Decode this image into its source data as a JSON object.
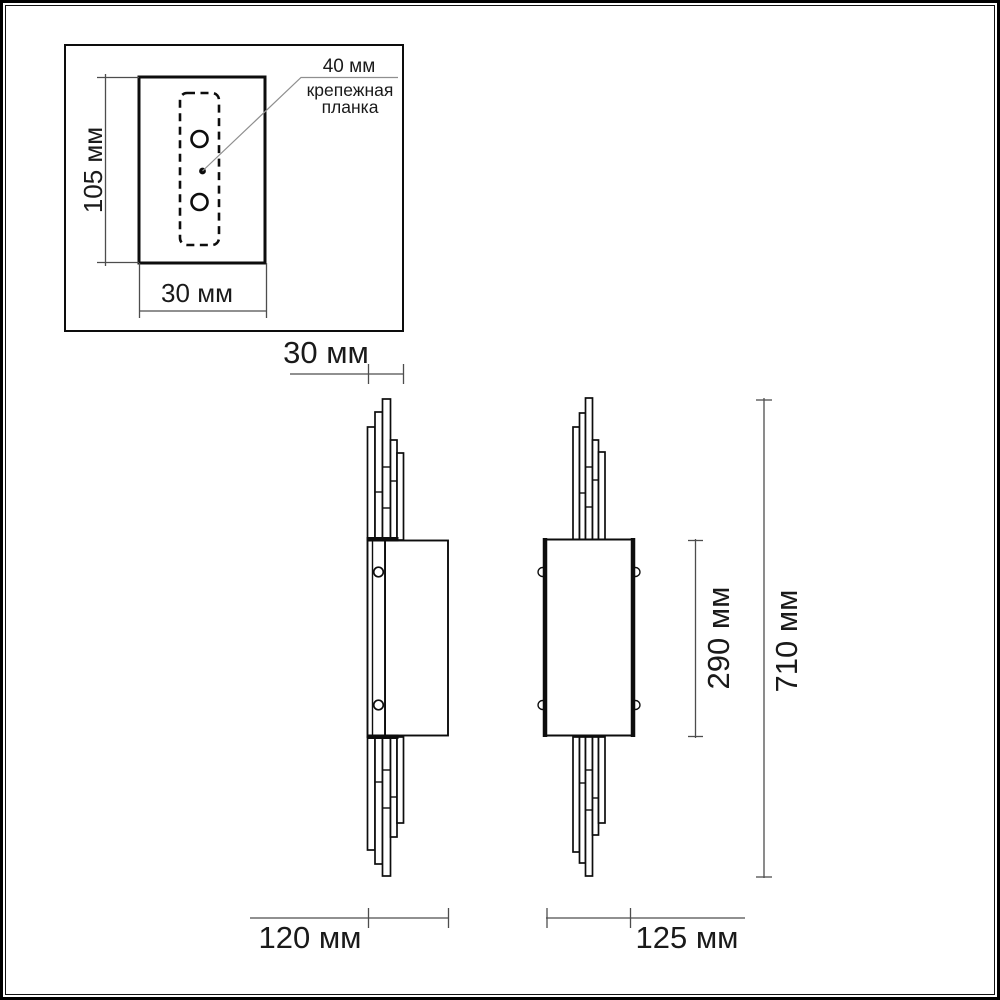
{
  "page": {
    "background": "#ffffff"
  },
  "diagram": {
    "kind": "wall-lamp dimension drawing",
    "unit": "мм",
    "inset": {
      "plate_height_label": "105 мм",
      "plate_width_label": "30 мм",
      "callout_value": "40 мм",
      "callout_name_line1": "крепежная",
      "callout_name_line2": "планка"
    },
    "main": {
      "depth_label": "30 мм",
      "side_width_label": "120 мм",
      "front_width_label": "125 мм",
      "body_height_label": "290 мм",
      "overall_height_label": "710 мм"
    },
    "colors": {
      "drawing_line": "#0d0d0d",
      "dimension_line": "#4d4d4d",
      "leader_line": "#8f8f8f",
      "text": "#1a1a1a",
      "background": "#ffffff"
    }
  }
}
